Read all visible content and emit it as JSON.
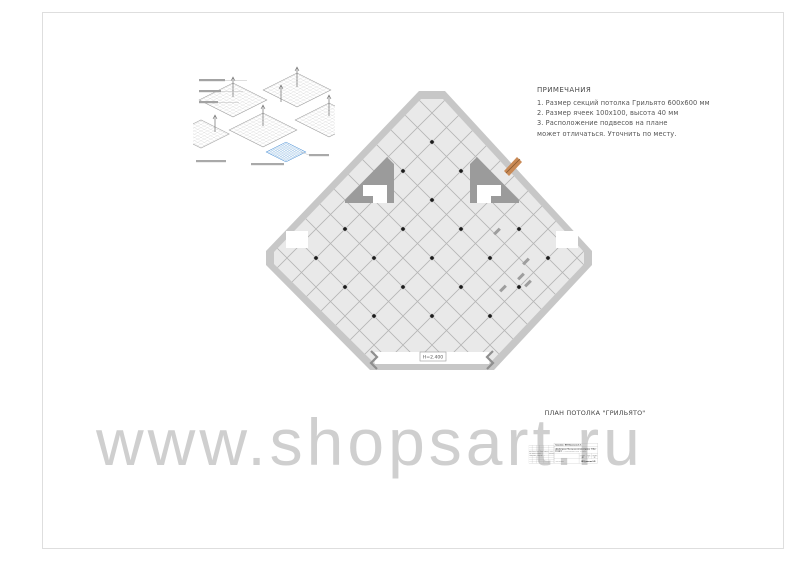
{
  "notes": {
    "title": "ПРИМЕЧАНИЯ",
    "lines": [
      "1. Размер секций потолка Грильято 600х600 мм",
      "2. Размер ячеек 100х100, высота 40 мм",
      "3. Расположение подвесов на плане",
      "может отличаться. Уточнить по месту."
    ]
  },
  "plan": {
    "caption": "ПЛАН ПОТОЛКА \"ГРИЛЬЯТО\"",
    "height_label": "Н=2.400"
  },
  "watermark": "www.shopsart.ru",
  "title_block": {
    "client_label": "Заказчик:",
    "client": "ИП Николаева Е.Г.",
    "project_line": "Дизайн-проект Мастерская мягких игрушек \"Filius\"",
    "address_label": "по адресу:",
    "address": "ТЦ Гранд Каньон, г.Санкт -Петербург.",
    "stamp_headers": [
      "Изм.",
      "Кол.уч",
      "Лист",
      "№док.",
      "Подпись",
      "Дата"
    ],
    "rows": [
      {
        "role": "Рук. проекта",
        "name": "Голова Е.А.",
        "date": "19.09.22."
      },
      {
        "role": "Архитектор",
        "name": "Андреева А.А.",
        "date": ""
      }
    ],
    "stage_header": "Стадия",
    "sheet_header": "Лист",
    "sheets_header": "Листов",
    "stage": "ДП",
    "sheet": "7",
    "sheets": "22",
    "drawing_title": "План потолка",
    "company": "ИП Денисенко О.П."
  },
  "colors": {
    "wall": "#c7c7c7",
    "interior": "#e9e9e9",
    "grid_line": "#b5b5b5",
    "dark_wedge": "#9b9b9b",
    "door_orange": "#c98a56",
    "sample_blue": "#5b9bd5",
    "watermark_gray": "#8e8e8e"
  }
}
